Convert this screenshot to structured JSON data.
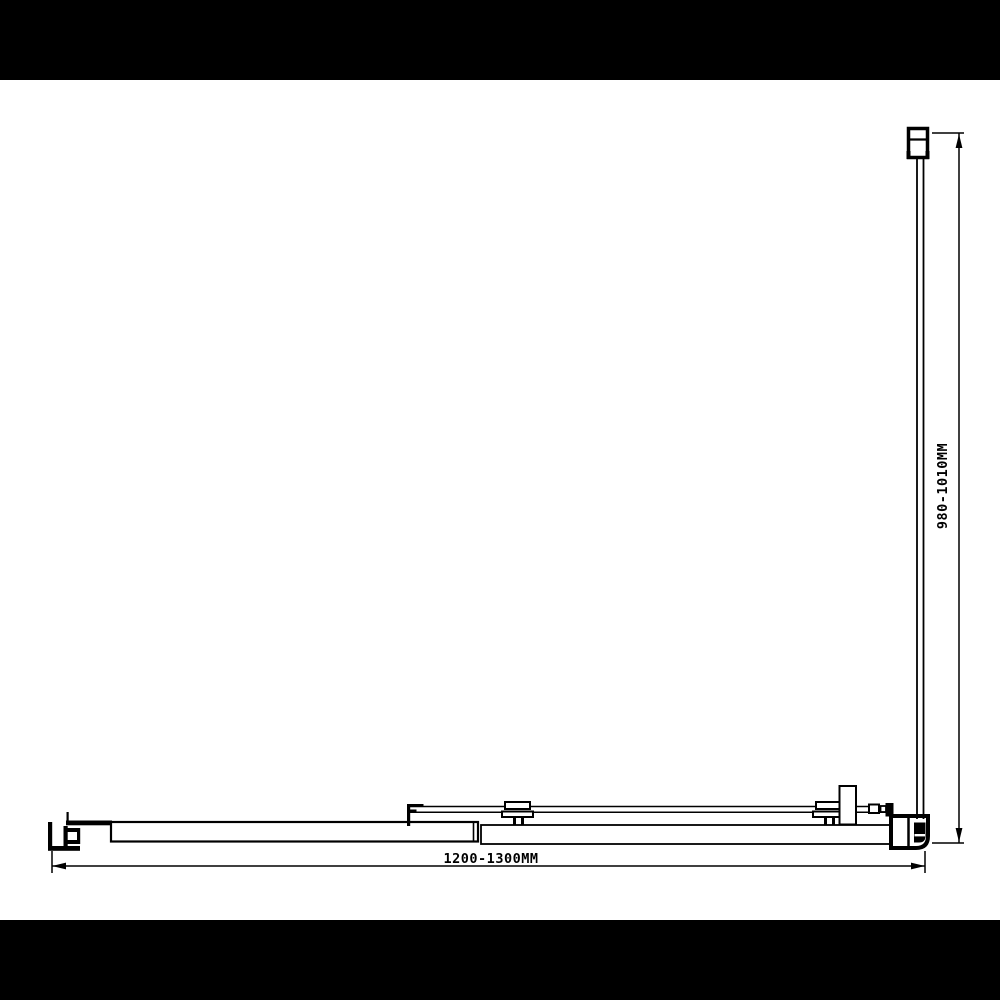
{
  "drawing": {
    "description": "Technical top-view line drawing of a corner shower enclosure with sliding door panel, fixed side panel and dimension lines",
    "colors": {
      "background": "#ffffff",
      "line": "#000000",
      "letterbox": "#000000"
    },
    "dimensions": {
      "width": {
        "label": "1200-1300MM",
        "orientation": "horizontal"
      },
      "height": {
        "label": "980-1010MM",
        "orientation": "vertical-rotated"
      }
    },
    "components": [
      "wall-profile-left",
      "sliding-door-bar",
      "fixed-bottom-panel",
      "door-rail",
      "roller-bracket-1",
      "roller-bracket-2",
      "door-handle",
      "rail-end-clamps",
      "corner-post",
      "side-glass-panel",
      "top-wall-bracket"
    ]
  }
}
